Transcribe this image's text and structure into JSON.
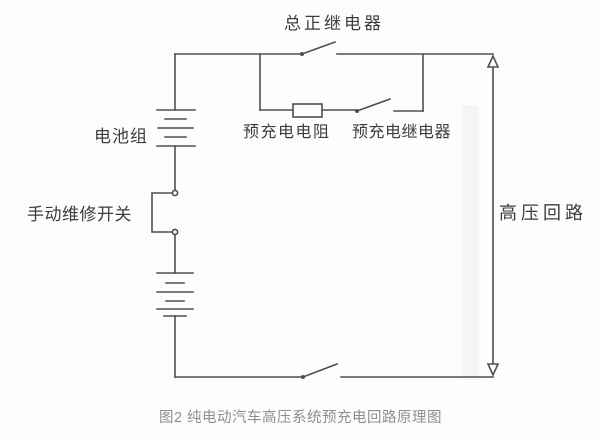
{
  "figure": {
    "labels": {
      "main_positive_relay": "总正继电器",
      "battery_pack": "电池组",
      "precharge_resistor": "预充电电阻",
      "precharge_relay": "预充电继电器",
      "manual_service_switch": "手动维修开关",
      "high_voltage_loop": "高压回路"
    },
    "caption": "图2 纯电动汽车高压系统预充电回路原理图",
    "colors": {
      "wire": "#4f4f4f",
      "label_text": "#3d3d3d",
      "caption_text": "#8e8e8e",
      "background": "#fdfdfd"
    }
  }
}
